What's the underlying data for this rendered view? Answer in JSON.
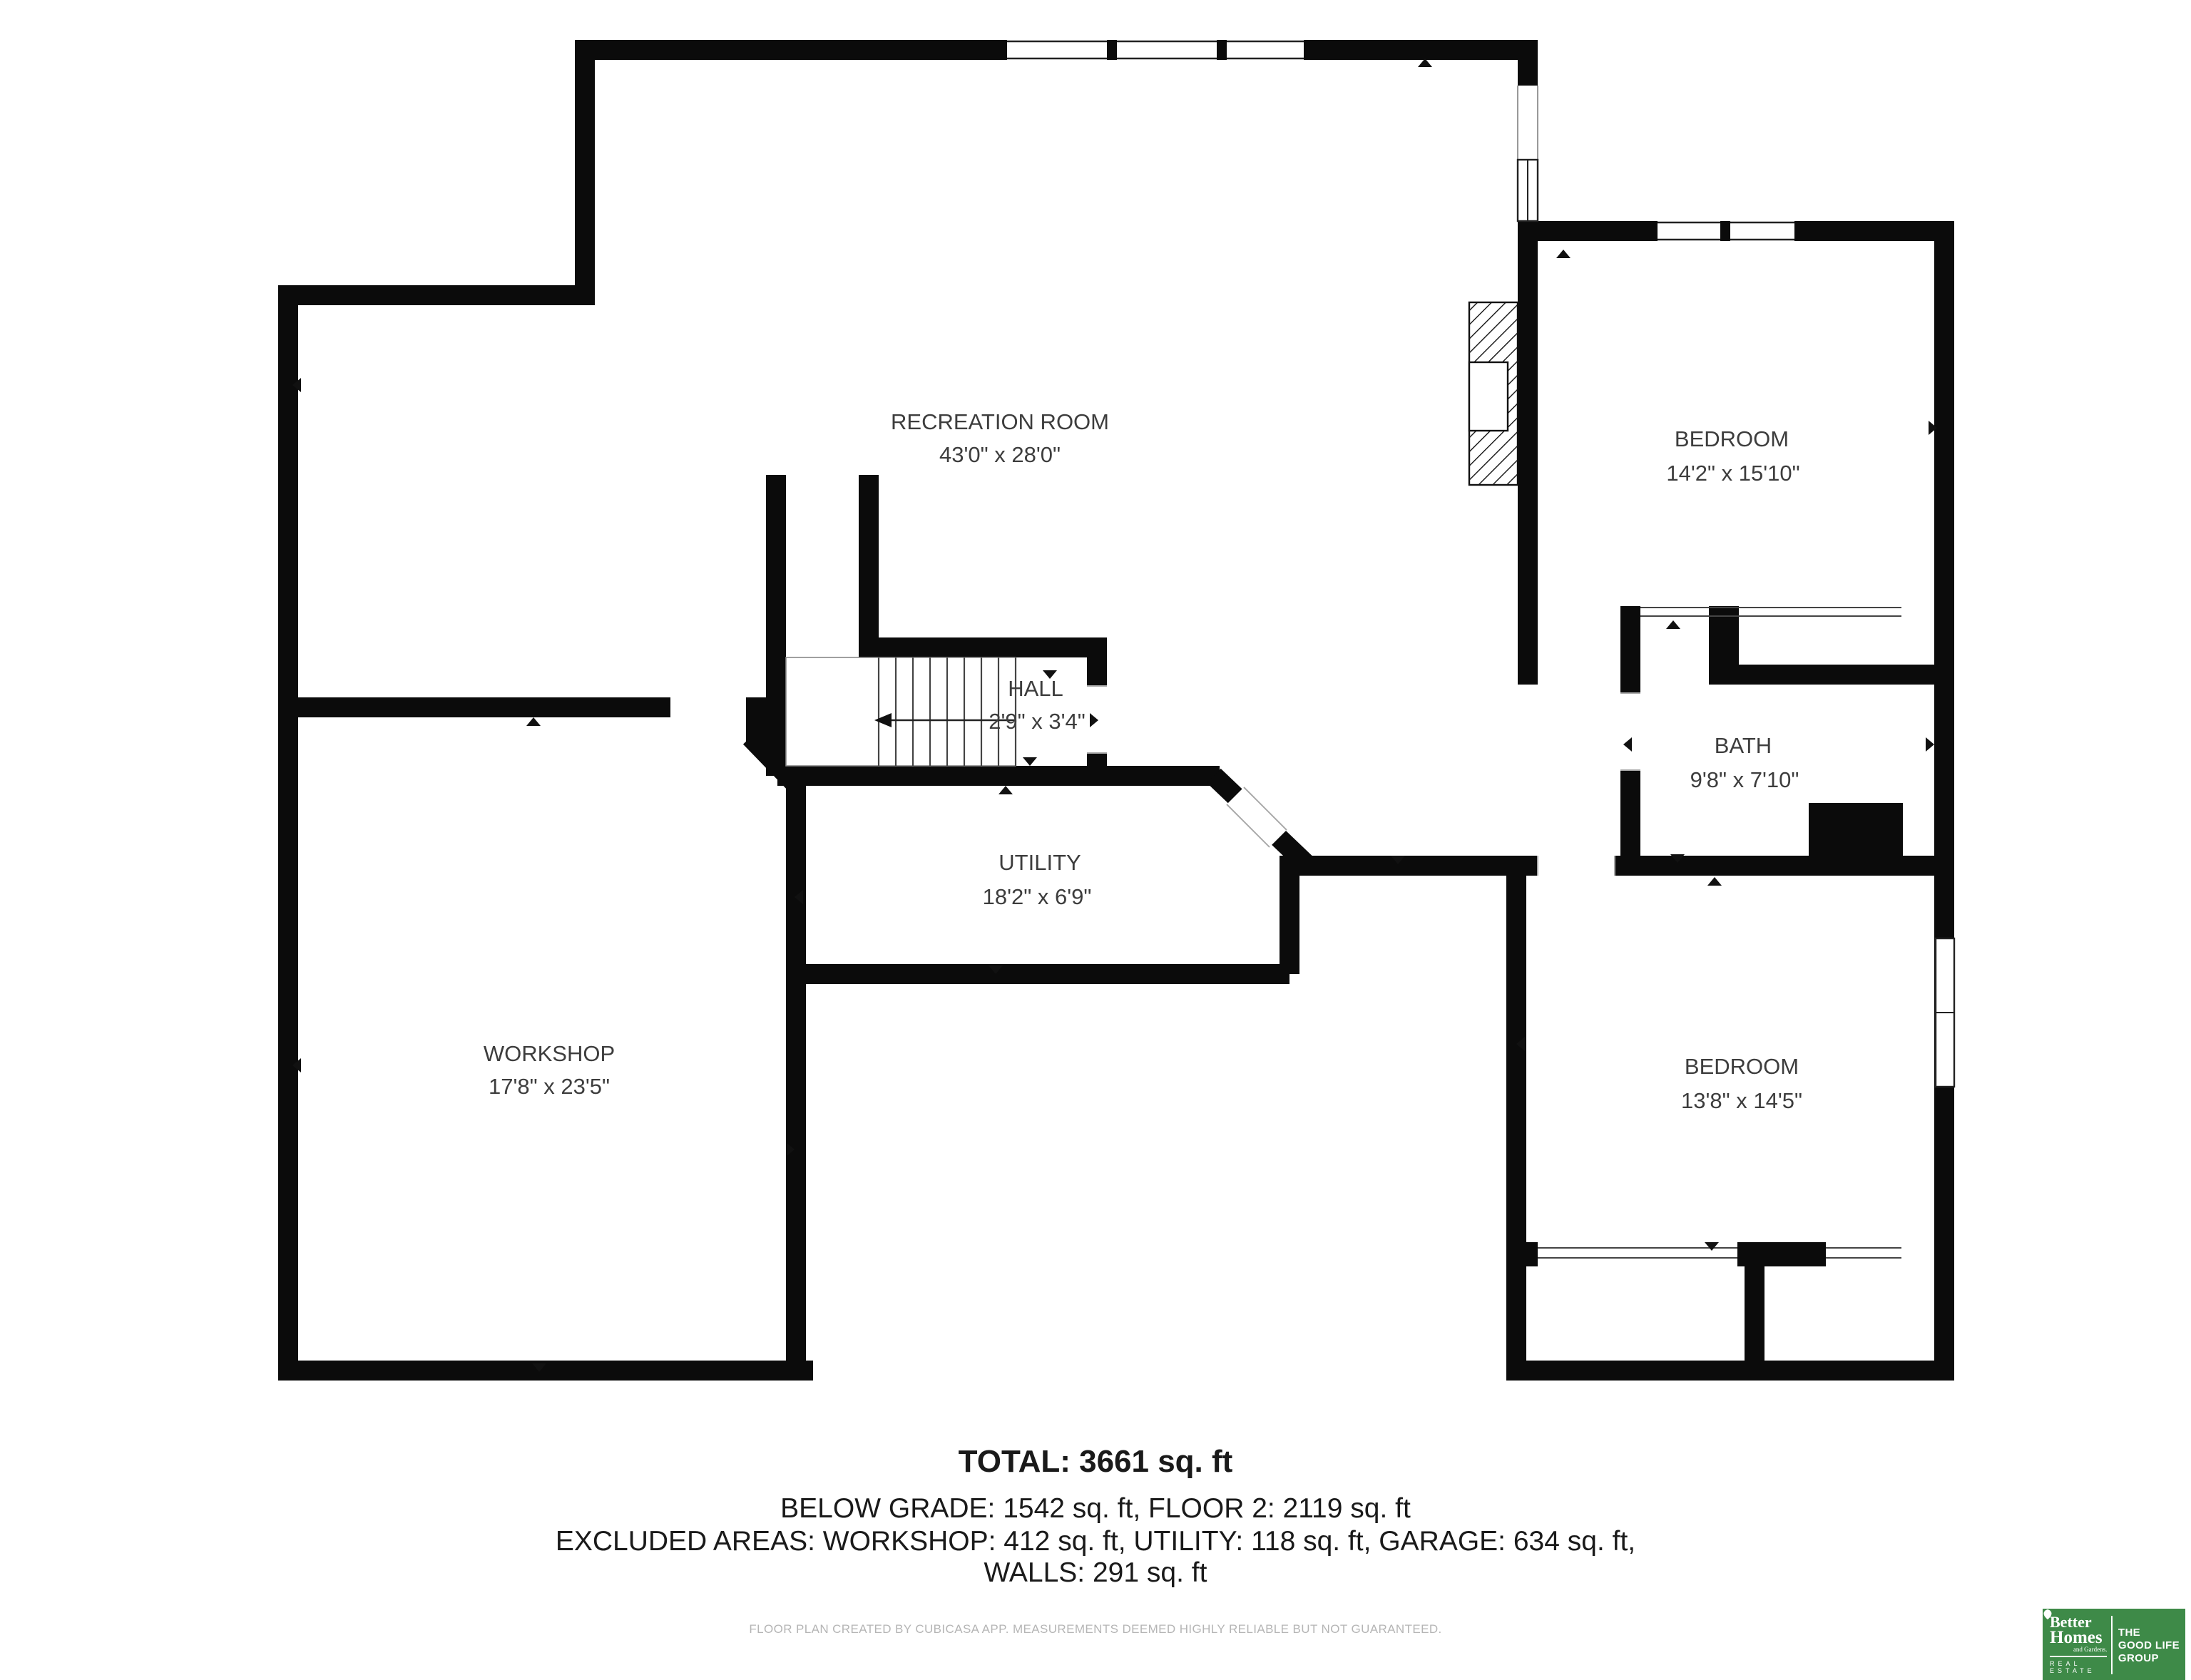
{
  "plan": {
    "rooms": [
      {
        "id": "recreation-room",
        "name": "RECREATION ROOM",
        "dims": "43'0\" x 28'0\""
      },
      {
        "id": "hall",
        "name": "HALL",
        "dims": "2'9\" x 3'4\""
      },
      {
        "id": "utility",
        "name": "UTILITY",
        "dims": "18'2\" x 6'9\""
      },
      {
        "id": "workshop",
        "name": "WORKSHOP",
        "dims": "17'8\" x 23'5\""
      },
      {
        "id": "bedroom-upper",
        "name": "BEDROOM",
        "dims": "14'2\" x 15'10\""
      },
      {
        "id": "bath",
        "name": "BATH",
        "dims": "9'8\" x 7'10\""
      },
      {
        "id": "bedroom-lower",
        "name": "BEDROOM",
        "dims": "13'8\" x 14'5\""
      }
    ]
  },
  "summary": {
    "total": "TOTAL: 3661 sq. ft",
    "line2": "BELOW GRADE: 1542 sq. ft, FLOOR 2: 2119 sq. ft",
    "line3": "EXCLUDED AREAS: WORKSHOP: 412 sq. ft, UTILITY: 118 sq. ft, GARAGE: 634 sq. ft,",
    "line4": "WALLS: 291 sq. ft"
  },
  "disclaimer": "FLOOR PLAN CREATED BY CUBICASA APP. MEASUREMENTS DEEMED HIGHLY RELIABLE BUT NOT GUARANTEED.",
  "logo": {
    "brand_top": "Better",
    "brand_mid": "Homes",
    "brand_sub": "and Gardens.",
    "brand_bottom": "REAL ESTATE",
    "tagline_1": "THE",
    "tagline_2": "GOOD LIFE",
    "tagline_3": "GROUP",
    "green": "#3e8a48"
  },
  "colors": {
    "wall": "#0b0b0b",
    "label": "#3d3d3d",
    "disclaimer_gray": "#b5b5b5"
  }
}
